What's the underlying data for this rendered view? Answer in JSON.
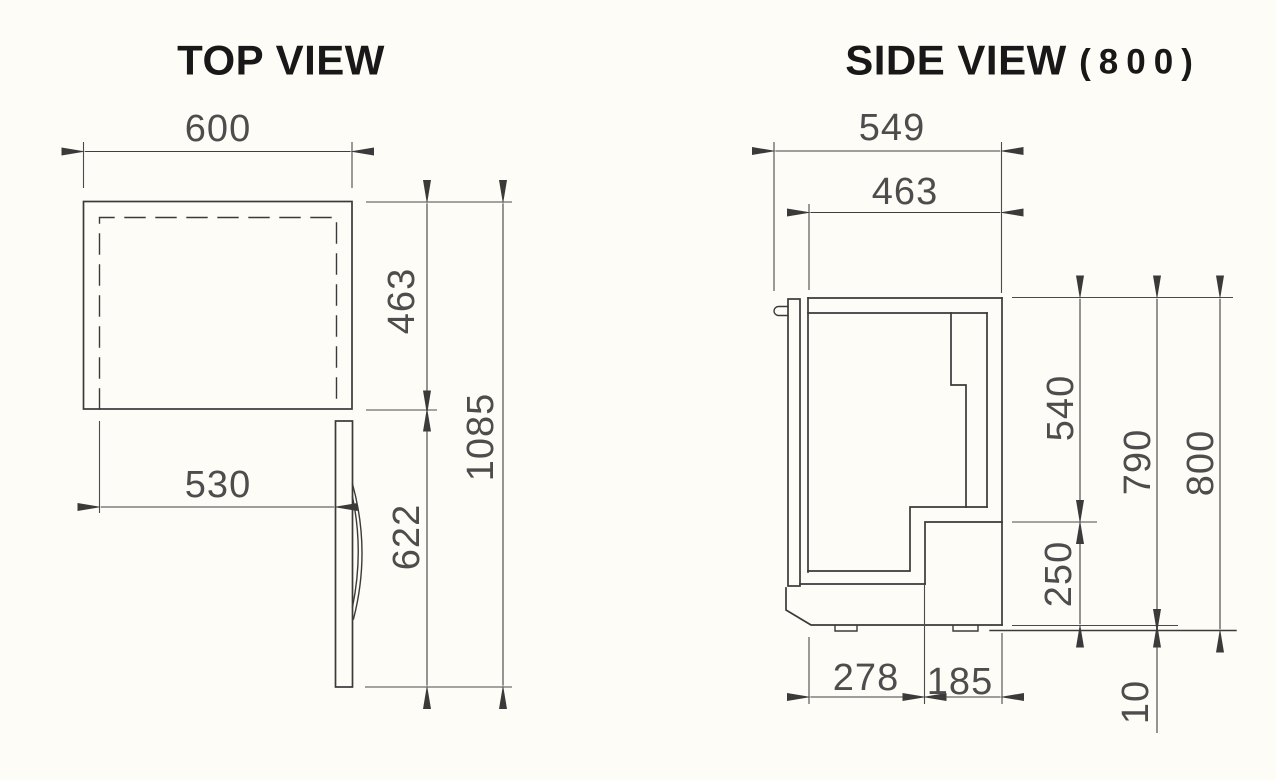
{
  "top_view": {
    "title": "TOP VIEW",
    "dims": {
      "width": "600",
      "depth": "463",
      "opening_width": "530",
      "door_swing": "622",
      "total_depth_door_open": "1085"
    }
  },
  "side_view": {
    "title": "SIDE VIEW",
    "subtitle": "(800)",
    "dims": {
      "total_depth": "549",
      "body_depth": "463",
      "upper_section_height": "540",
      "body_height": "790",
      "total_height": "800",
      "compressor_height": "250",
      "base_front_depth": "278",
      "base_back_depth": "185",
      "foot_height": "10"
    }
  }
}
